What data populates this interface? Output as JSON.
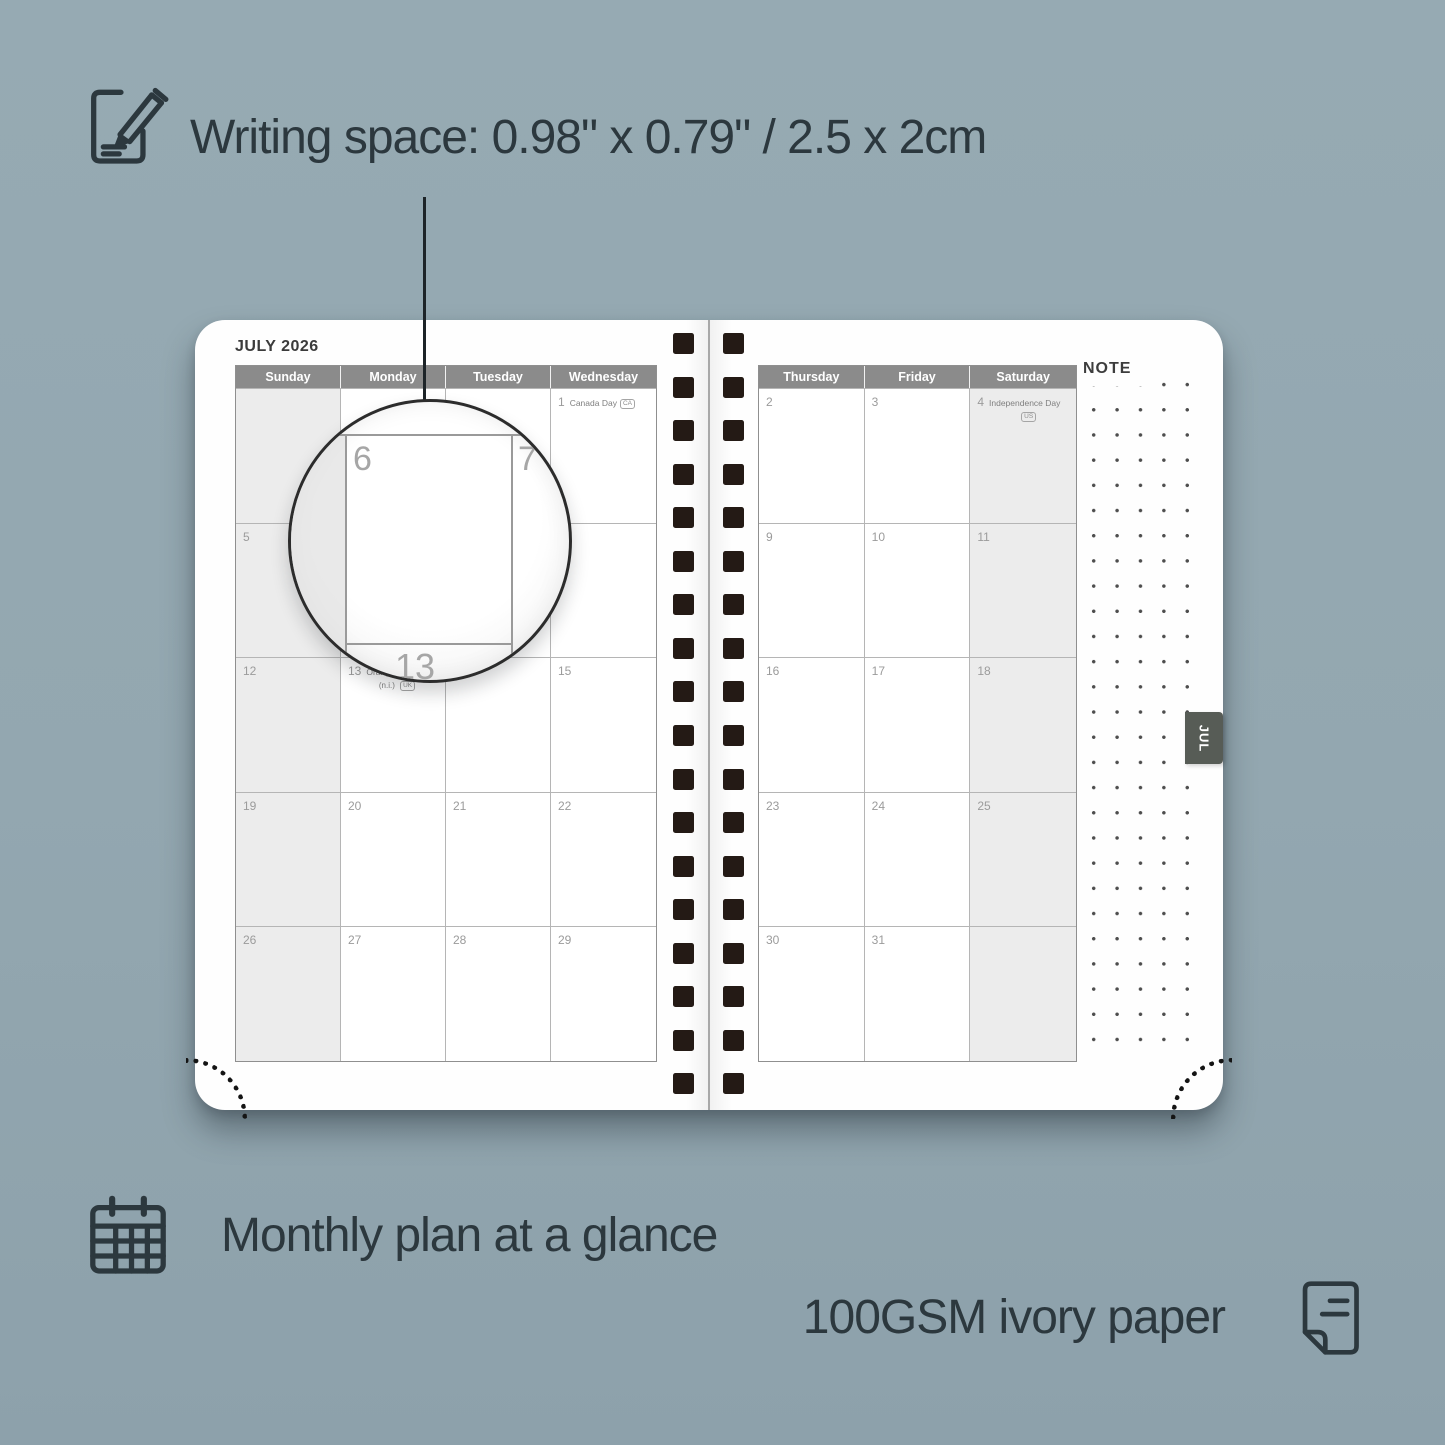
{
  "colors": {
    "background": "#93a7b0",
    "annotation_text": "#2c383e",
    "calendar_header": "#8b8b8b",
    "shaded_cell": "#ececec",
    "month_tab": "#575c56",
    "binding_hole": "#241a15"
  },
  "annotations": {
    "writing_space": "Writing space: 0.98\" x 0.79\" / 2.5 x 2cm",
    "monthly_plan": "Monthly plan at a glance",
    "paper": "100GSM ivory paper"
  },
  "planner": {
    "month_title": "JULY 2026",
    "note_label": "NOTE",
    "tab_label": "JUL",
    "left_page": {
      "day_headers": [
        "Sunday",
        "Monday",
        "Tuesday",
        "Wednesday"
      ],
      "shaded_column": 0,
      "weeks": [
        [
          {
            "date": ""
          },
          {
            "date": ""
          },
          {
            "date": ""
          },
          {
            "date": "1",
            "holiday": "Canada Day",
            "badge": "CA",
            "badge_pos": "inline"
          }
        ],
        [
          {
            "date": "5"
          },
          {
            "date": "6"
          },
          {
            "date": "7"
          },
          {
            "date": "8"
          }
        ],
        [
          {
            "date": "12"
          },
          {
            "date": "13",
            "holiday": "Orangemen's Day",
            "sub": "(n.i.)",
            "badge": "UK",
            "badge_pos": "below"
          },
          {
            "date": "14"
          },
          {
            "date": "15"
          }
        ],
        [
          {
            "date": "19"
          },
          {
            "date": "20"
          },
          {
            "date": "21"
          },
          {
            "date": "22"
          }
        ],
        [
          {
            "date": "26"
          },
          {
            "date": "27"
          },
          {
            "date": "28"
          },
          {
            "date": "29"
          }
        ]
      ]
    },
    "right_page": {
      "day_headers": [
        "Thursday",
        "Friday",
        "Saturday"
      ],
      "shaded_column": 2,
      "weeks": [
        [
          {
            "date": "2"
          },
          {
            "date": "3"
          },
          {
            "date": "4",
            "holiday": "Independence Day",
            "badge": "US",
            "badge_pos": "below"
          }
        ],
        [
          {
            "date": "9"
          },
          {
            "date": "10"
          },
          {
            "date": "11"
          }
        ],
        [
          {
            "date": "16"
          },
          {
            "date": "17"
          },
          {
            "date": "18"
          }
        ],
        [
          {
            "date": "23"
          },
          {
            "date": "24"
          },
          {
            "date": "25"
          }
        ],
        [
          {
            "date": "30"
          },
          {
            "date": "31"
          },
          {
            "date": ""
          }
        ]
      ]
    },
    "magnifier": {
      "top_left_date": "6",
      "top_right_date": "7",
      "bottom_date": "13"
    }
  }
}
